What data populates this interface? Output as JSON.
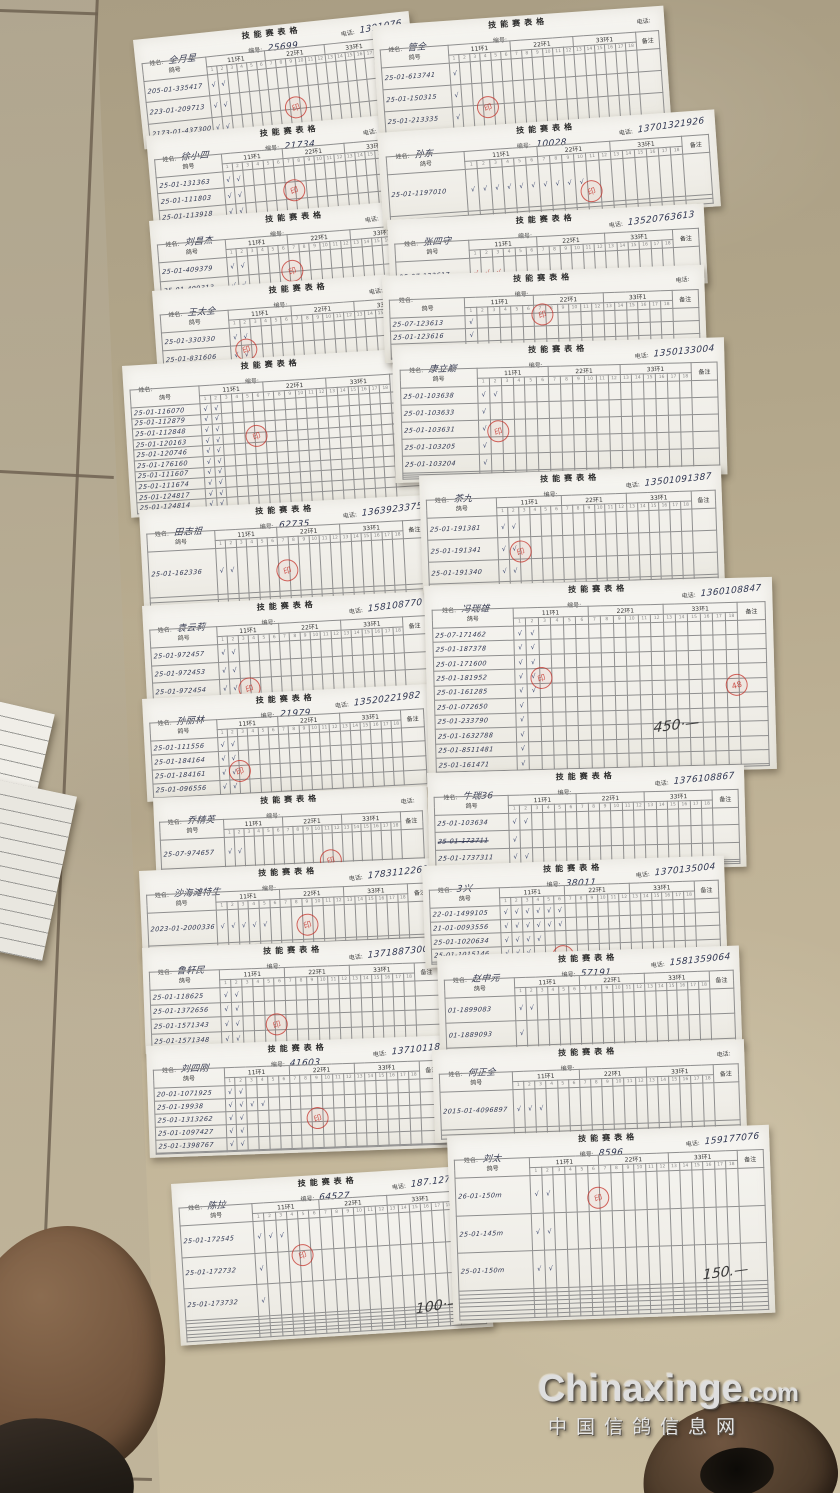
{
  "scene": {
    "width": 840,
    "height": 1493
  },
  "watermark": {
    "line1": "Chinaxinge",
    "line1_suffix": ".com",
    "line2": "中国信鸽信息网"
  },
  "floor": {
    "tile_color": "#b9ac90",
    "grout_color": "#6e6251"
  },
  "labels": {
    "title": "技能赛表格",
    "name": "姓名:",
    "number": "编号:",
    "phone": "电话:",
    "ring_col": "鸽号",
    "sub_ring": "足环号码",
    "groups": [
      "11环1",
      "22环1",
      "33环1"
    ],
    "note_col": "备注",
    "check": "√",
    "stamp": "印"
  },
  "forms": [
    {
      "id": "L1",
      "x": 133,
      "y": 40,
      "w": 277,
      "h": 110,
      "rot": -6,
      "name": "全月星",
      "number": "25699",
      "phone": "1391076",
      "blank_rows": 0,
      "note": "",
      "stamps": [
        {
          "left": 52,
          "top": 66,
          "label": "印"
        }
      ],
      "rows": [
        {
          "ring": "205-01-335417",
          "checks": 2
        },
        {
          "ring": "223-01-209713",
          "checks": 2
        },
        {
          "ring": "2173-01-437300",
          "checks": 2
        }
      ]
    },
    {
      "id": "L2",
      "x": 146,
      "y": 136,
      "w": 287,
      "h": 97,
      "rot": -5,
      "name": "徐小四",
      "number": "21734",
      "phone": "1313200",
      "blank_rows": 1,
      "note": "",
      "stamps": [
        {
          "left": 46,
          "top": 58,
          "label": "印"
        }
      ],
      "rows": [
        {
          "ring": "25-01-131363",
          "checks": 2
        },
        {
          "ring": "25-01-111803",
          "checks": 2
        },
        {
          "ring": "25-01-113918",
          "checks": 2
        }
      ]
    },
    {
      "id": "L3",
      "x": 149,
      "y": 221,
      "w": 292,
      "h": 86,
      "rot": -4.5,
      "name": "刘昌杰",
      "number": "",
      "phone": "13521333",
      "blank_rows": 1,
      "note": "",
      "stamps": [
        {
          "left": 44,
          "top": 58,
          "label": "印"
        }
      ],
      "rows": [
        {
          "ring": "25-01-409379",
          "checks": 2
        },
        {
          "ring": "25-01-409313",
          "checks": 2
        }
      ]
    },
    {
      "id": "L4",
      "x": 152,
      "y": 291,
      "w": 293,
      "h": 84,
      "rot": -4,
      "name": "王太全",
      "number": "",
      "phone": "18810767",
      "blank_rows": 1,
      "note": "",
      "stamps": [
        {
          "left": 27,
          "top": 64,
          "label": "印"
        }
      ],
      "rows": [
        {
          "ring": "25-01-330330",
          "checks": 2
        },
        {
          "ring": "25-01-831606",
          "checks": 2
        }
      ]
    },
    {
      "id": "L5",
      "x": 122,
      "y": 366,
      "w": 297,
      "h": 152,
      "rot": -3.5,
      "name": "",
      "number": "",
      "phone": "",
      "blank_rows": 0,
      "note": "",
      "stamps": [
        {
          "left": 40,
          "top": 44,
          "label": "印"
        }
      ],
      "rows": [
        {
          "ring": "25-01-116070",
          "checks": 2
        },
        {
          "ring": "25-01-112879",
          "checks": 2
        },
        {
          "ring": "25-01-112848",
          "checks": 2
        },
        {
          "ring": "25-01-120163",
          "checks": 2
        },
        {
          "ring": "25-01-120746",
          "checks": 2
        },
        {
          "ring": "25-01-176160",
          "checks": 2
        },
        {
          "ring": "25-01-111607",
          "checks": 2
        },
        {
          "ring": "25-01-111674",
          "checks": 2
        },
        {
          "ring": "25-01-124817",
          "checks": 2
        },
        {
          "ring": "25-01-124814",
          "checks": 2
        }
      ]
    },
    {
      "id": "L6",
      "x": 139,
      "y": 510,
      "w": 292,
      "h": 102,
      "rot": -3,
      "name": "田志祖",
      "number": "62735",
      "phone": "1363923375",
      "blank_rows": 2,
      "note": "",
      "stamps": [
        {
          "left": 46,
          "top": 56,
          "label": "印"
        }
      ],
      "rows": [
        {
          "ring": "25-01-162336",
          "checks": 2
        }
      ]
    },
    {
      "id": "L7",
      "x": 142,
      "y": 606,
      "w": 289,
      "h": 101,
      "rot": -3,
      "name": "袁云莉",
      "number": "",
      "phone": "158108770",
      "blank_rows": 1,
      "note": "",
      "stamps": [
        {
          "left": 32,
          "top": 76,
          "label": "印"
        }
      ],
      "rows": [
        {
          "ring": "25-01-972457",
          "checks": 2
        },
        {
          "ring": "25-01-972453",
          "checks": 2
        },
        {
          "ring": "25-01-972454",
          "checks": 2
        }
      ]
    },
    {
      "id": "L8",
      "x": 142,
      "y": 699,
      "w": 287,
      "h": 103,
      "rot": -3,
      "name": "孙丽林",
      "number": "21979",
      "phone": "13520221982",
      "blank_rows": 0,
      "note": "",
      "stamps": [
        {
          "left": 29,
          "top": 64,
          "label": "印"
        }
      ],
      "rows": [
        {
          "ring": "25-01-111556",
          "checks": 2
        },
        {
          "ring": "25-01-184164",
          "checks": 2
        },
        {
          "ring": "25-01-184161",
          "checks": 2
        },
        {
          "ring": "25-01-096556",
          "checks": 2
        }
      ]
    },
    {
      "id": "L9",
      "x": 153,
      "y": 798,
      "w": 274,
      "h": 82,
      "rot": -2.5,
      "name": "乔精英",
      "number": "",
      "phone": "",
      "blank_rows": 2,
      "note": "",
      "stamps": [
        {
          "left": 60,
          "top": 72,
          "label": "印"
        }
      ],
      "rows": [
        {
          "ring": "25-07-974657",
          "checks": 2
        }
      ]
    },
    {
      "id": "L10",
      "x": 139,
      "y": 871,
      "w": 298,
      "h": 86,
      "rot": -2.5,
      "name": "沙海滩特生",
      "number": "",
      "phone": "1783112261",
      "blank_rows": 2,
      "note": "",
      "stamps": [
        {
          "left": 52,
          "top": 58,
          "label": "印"
        }
      ],
      "rows": [
        {
          "ring": "2023-01-2000336",
          "checks": 5
        }
      ]
    },
    {
      "id": "L11",
      "x": 142,
      "y": 948,
      "w": 302,
      "h": 106,
      "rot": -2,
      "name": "鲁轩民",
      "number": "",
      "phone": "13718873000",
      "blank_rows": 1,
      "note": "",
      "stamps": [
        {
          "left": 40,
          "top": 66,
          "label": "印"
        }
      ],
      "rows": [
        {
          "ring": "25-01-118625",
          "checks": 2
        },
        {
          "ring": "25-01-1372656",
          "checks": 2
        },
        {
          "ring": "25-01-1571343",
          "checks": 2
        },
        {
          "ring": "25-01-1571348",
          "checks": 2
        }
      ]
    },
    {
      "id": "L12",
      "x": 146,
      "y": 1046,
      "w": 303,
      "h": 112,
      "rot": -2,
      "name": "刘四刚",
      "number": "41603",
      "phone": "13710118",
      "blank_rows": 1,
      "note": "",
      "stamps": [
        {
          "left": 52,
          "top": 60,
          "label": "印"
        }
      ],
      "rows": [
        {
          "ring": "20-01-1071925",
          "checks": 2
        },
        {
          "ring": "25-01-19938",
          "checks": 4
        },
        {
          "ring": "25-01-1313262",
          "checks": 2
        },
        {
          "ring": "25-01-1097427",
          "checks": 2
        },
        {
          "ring": "25-01-1398767",
          "checks": 2
        }
      ]
    },
    {
      "id": "L14",
      "x": 171,
      "y": 1184,
      "w": 313,
      "h": 162,
      "rot": -3.5,
      "name": "陈拉",
      "number": "64527",
      "phone": "187.1272295",
      "blank_rows": 6,
      "note": "100·—",
      "note_right": 10,
      "note_bottom": 10,
      "stamps": [
        {
          "left": 37,
          "top": 42,
          "label": "印"
        }
      ],
      "rows": [
        {
          "ring": "25-01-172545",
          "checks": 3
        },
        {
          "ring": "25-01-172732",
          "checks": 1
        },
        {
          "ring": "25-01-173732",
          "checks": 1
        }
      ]
    },
    {
      "id": "R1",
      "x": 372,
      "y": 26,
      "w": 292,
      "h": 114,
      "rot": -4,
      "name": "管全",
      "number": "",
      "phone": "",
      "blank_rows": 1,
      "note": "",
      "stamps": [
        {
          "left": 34,
          "top": 68,
          "label": "印"
        }
      ],
      "rows": [
        {
          "ring": "25-01-613741",
          "checks": 1
        },
        {
          "ring": "25-01-150315",
          "checks": 1
        },
        {
          "ring": "25-01-213335",
          "checks": 1
        }
      ]
    },
    {
      "id": "R2",
      "x": 377,
      "y": 133,
      "w": 338,
      "h": 97,
      "rot": -4,
      "name": "孙东",
      "number": "10028",
      "phone": "13701321926",
      "blank_rows": 2,
      "note": "",
      "stamps": [
        {
          "left": 59,
          "top": 64,
          "label": "印"
        }
      ],
      "rows": [
        {
          "ring": "25-01-1197010",
          "checks": 10
        }
      ]
    },
    {
      "id": "R3",
      "x": 387,
      "y": 220,
      "w": 317,
      "h": 80,
      "rot": -3,
      "name": "张四守",
      "number": "",
      "phone": "13520763613",
      "blank_rows": 1,
      "note": "",
      "stamps": [],
      "rows": [
        {
          "ring": "25-07-123617",
          "checks": 3,
          "red": true
        }
      ]
    },
    {
      "id": "R4",
      "x": 382,
      "y": 276,
      "w": 322,
      "h": 87,
      "rot": -2,
      "name": "",
      "number": "",
      "phone": "",
      "blank_rows": 1,
      "note": "",
      "stamps": [
        {
          "left": 46,
          "top": 38,
          "label": "印"
        }
      ],
      "rows": [
        {
          "ring": "25-07-123613",
          "checks": 1
        },
        {
          "ring": "25-01-123616",
          "checks": 1
        },
        {
          "ring": "25-07-123615",
          "checks": 1
        }
      ]
    },
    {
      "id": "R5",
      "x": 392,
      "y": 346,
      "w": 332,
      "h": 137,
      "rot": -1.5,
      "name": "康立巅",
      "number": "",
      "phone": "1350133004",
      "blank_rows": 3,
      "note": "",
      "stamps": [
        {
          "left": 28,
          "top": 56,
          "label": "印"
        }
      ],
      "rows": [
        {
          "ring": "25-01-103638",
          "checks": 2
        },
        {
          "ring": "25-01-103633",
          "checks": 1
        },
        {
          "ring": "25-01-103631",
          "checks": 1
        },
        {
          "ring": "25-01-103205",
          "checks": 1
        },
        {
          "ring": "25-01-103204",
          "checks": 1
        }
      ]
    },
    {
      "id": "R6",
      "x": 419,
      "y": 476,
      "w": 302,
      "h": 117,
      "rot": -2,
      "name": "茶九",
      "number": "",
      "phone": "13501091387",
      "blank_rows": 2,
      "note": "",
      "stamps": [
        {
          "left": 29,
          "top": 58,
          "label": "印"
        }
      ],
      "rows": [
        {
          "ring": "25-01-191381",
          "checks": 2
        },
        {
          "ring": "25-01-191341",
          "checks": 2
        },
        {
          "ring": "25-01-191340",
          "checks": 2
        }
      ]
    },
    {
      "id": "R7",
      "x": 424,
      "y": 586,
      "w": 348,
      "h": 192,
      "rot": -1.5,
      "name": "冯瑞雄",
      "number": "",
      "phone": "1360108847",
      "blank_rows": 1,
      "note": "450·—",
      "note_right": 22,
      "note_bottom": 20,
      "stamps": [
        {
          "left": 30,
          "top": 44,
          "label": "印"
        },
        {
          "left": 86,
          "top": 50,
          "label": "48"
        }
      ],
      "rows": [
        {
          "ring": "25-07-171462",
          "checks": 2
        },
        {
          "ring": "25-01-187378",
          "checks": 2
        },
        {
          "ring": "25-01-171600",
          "checks": 2
        },
        {
          "ring": "25-01-181952",
          "checks": 2
        },
        {
          "ring": "25-01-161285",
          "checks": 2
        },
        {
          "ring": "25-01-072650",
          "checks": 1
        },
        {
          "ring": "25-01-233790",
          "checks": 1
        },
        {
          "ring": "25-01-1632788",
          "checks": 1
        },
        {
          "ring": "25-01-8511481",
          "checks": 1
        },
        {
          "ring": "25-01-161471",
          "checks": 1
        }
      ]
    },
    {
      "id": "R8",
      "x": 427,
      "y": 773,
      "w": 317,
      "h": 102,
      "rot": -1.5,
      "name": "牛瑞36",
      "number": "",
      "phone": "1376108867",
      "blank_rows": 2,
      "note": "",
      "stamps": [],
      "rows": [
        {
          "ring": "25-01-103634",
          "checks": 2
        },
        {
          "ring": "25-01-173711",
          "checks": 1,
          "strike": true
        },
        {
          "ring": "25-01-1737311",
          "checks": 2
        }
      ]
    },
    {
      "id": "R9",
      "x": 422,
      "y": 866,
      "w": 302,
      "h": 102,
      "rot": -2,
      "name": "3兴",
      "number": "38011",
      "phone": "1370135004",
      "blank_rows": 1,
      "note": "",
      "stamps": [
        {
          "left": 42,
          "top": 82,
          "label": "印"
        }
      ],
      "rows": [
        {
          "ring": "22-01-1499105",
          "checks": 6
        },
        {
          "ring": "21-01-0093556",
          "checks": 6
        },
        {
          "ring": "25-01-1020634",
          "checks": 4
        },
        {
          "ring": "25-01-1015146",
          "checks": 3
        }
      ]
    },
    {
      "id": "R10",
      "x": 437,
      "y": 956,
      "w": 302,
      "h": 101,
      "rot": -2,
      "name": "赵申元",
      "number": "57191",
      "phone": "1581359064",
      "blank_rows": 2,
      "note": "",
      "stamps": [],
      "rows": [
        {
          "ring": "01-1899083",
          "checks": 2
        },
        {
          "ring": "01-1889093",
          "checks": 1
        }
      ]
    },
    {
      "id": "R11",
      "x": 432,
      "y": 1050,
      "w": 312,
      "h": 93,
      "rot": -2,
      "name": "何正全",
      "number": "",
      "phone": "",
      "blank_rows": 2,
      "note": "",
      "stamps": [],
      "rows": [
        {
          "ring": "2015-01-4096897",
          "checks": 3
        }
      ]
    },
    {
      "id": "R12",
      "x": 447,
      "y": 1136,
      "w": 322,
      "h": 188,
      "rot": -2,
      "name": "刘太",
      "number": "8596",
      "phone": "159177076",
      "blank_rows": 7,
      "note": "150.—",
      "note_right": 8,
      "note_bottom": 18,
      "stamps": [
        {
          "left": 43,
          "top": 30,
          "label": "印"
        }
      ],
      "rows": [
        {
          "ring": "26-01-150m",
          "checks": 2
        },
        {
          "ring": "25-01-145m",
          "checks": 2
        },
        {
          "ring": "25-01-150m",
          "checks": 2
        }
      ]
    }
  ]
}
